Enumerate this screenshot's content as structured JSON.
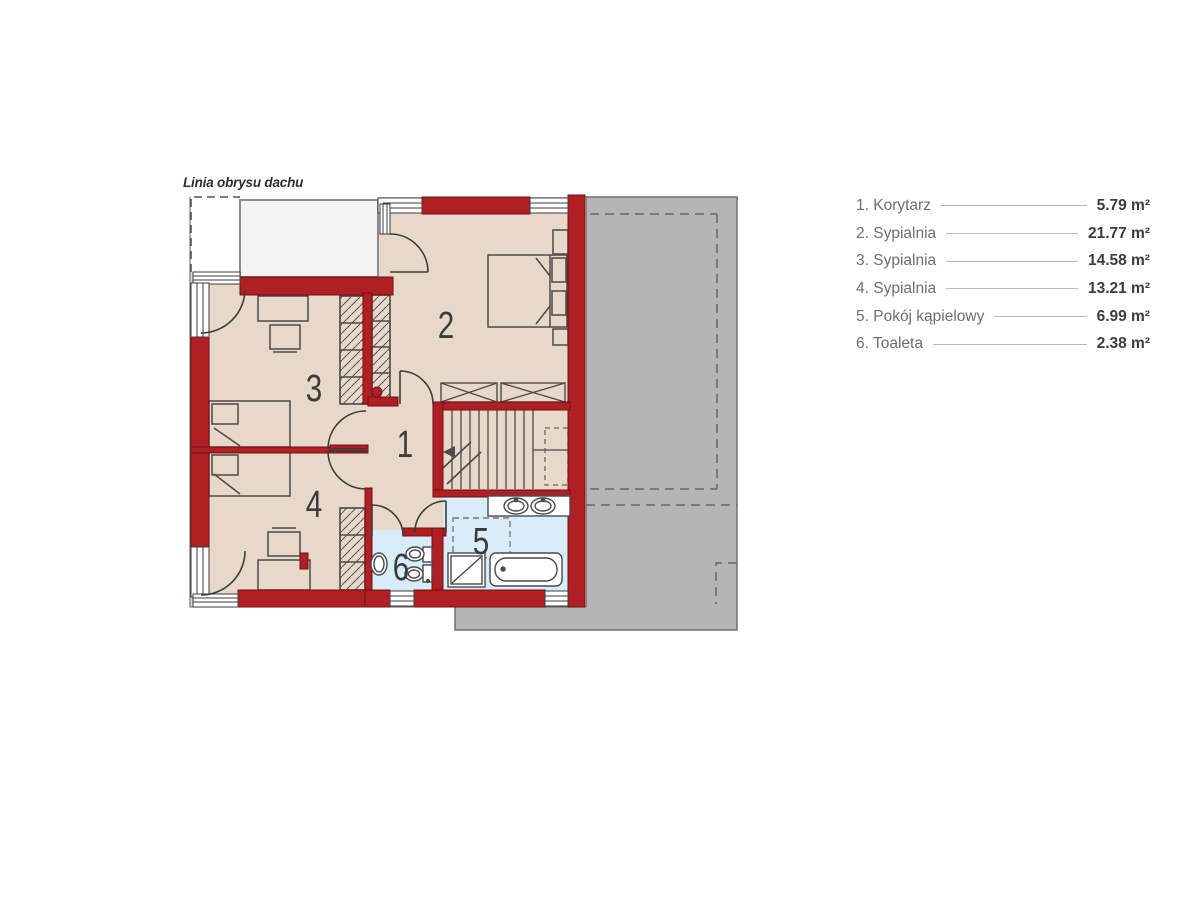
{
  "annotation": {
    "roof_outline_label": "Linia obrysu dachu"
  },
  "rooms": [
    {
      "number": "1",
      "legend_label": "1. Korytarz",
      "area": "5.79 m²"
    },
    {
      "number": "2",
      "legend_label": "2. Sypialnia",
      "area": "21.77 m²"
    },
    {
      "number": "3",
      "legend_label": "3. Sypialnia",
      "area": "14.58 m²"
    },
    {
      "number": "4",
      "legend_label": "4. Sypialnia",
      "area": "13.21 m²"
    },
    {
      "number": "5",
      "legend_label": "5. Pokój kąpielowy",
      "area": "6.99 m²"
    },
    {
      "number": "6",
      "legend_label": "6. Toaleta",
      "area": "2.38 m²"
    }
  ],
  "colors": {
    "wall": "#b01f24",
    "floor": "#e7d8c9",
    "wet": "#d8ecfa",
    "roof": "#b5b5b6",
    "balcony": "#f3f3f3",
    "line": "#3c3c3c",
    "legendlabel": "#6e6e6e",
    "legendvalue": "#3c3c3c"
  }
}
